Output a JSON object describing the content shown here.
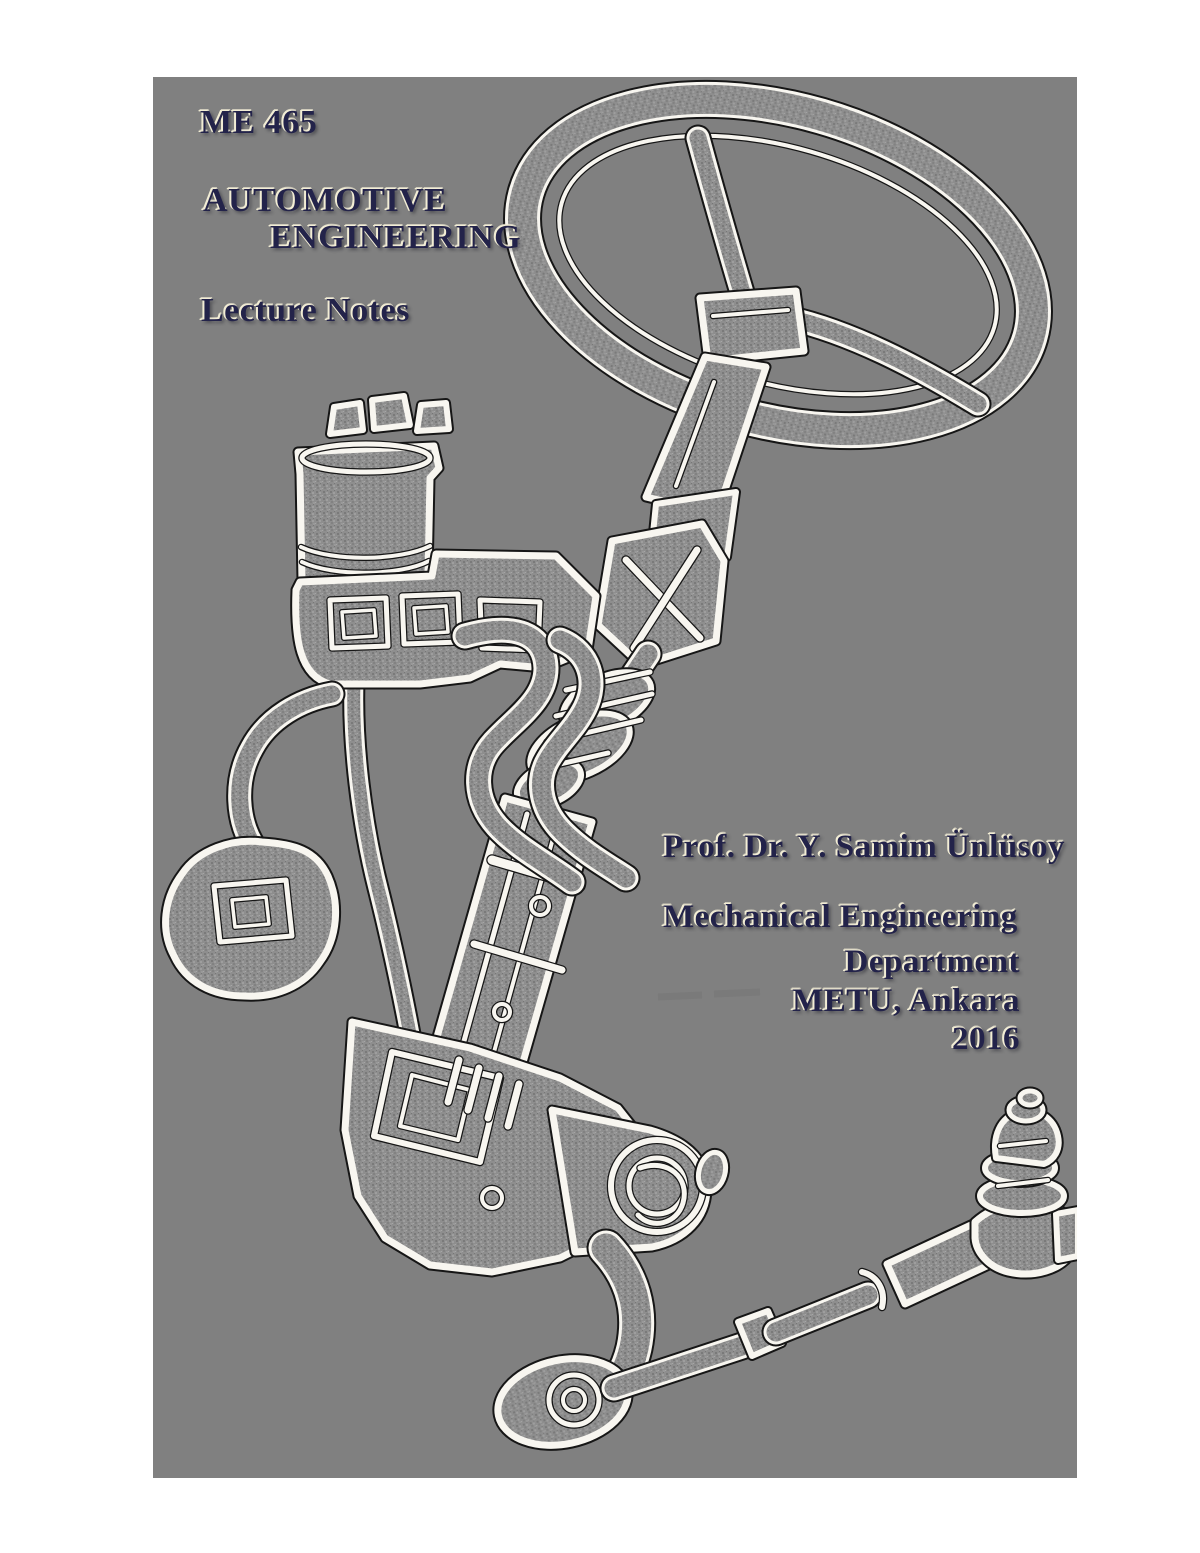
{
  "cover": {
    "course_code": "ME 465",
    "title_line1": "AUTOMOTIVE",
    "title_line2": "ENGINEERING",
    "subtitle": "Lecture Notes",
    "author": "Prof. Dr. Y. Samim Ünlüsoy",
    "department_line1": "Mechanical Engineering",
    "department_line2": "Department",
    "institution": "METU, Ankara",
    "year": "2016",
    "illustration_name": "power-steering-system-embossed-line-art",
    "colors": {
      "page_background": "#ffffff",
      "panel_background": "#808080",
      "text": "#23234a",
      "text_highlight": "#f2edd5",
      "edge_light": "#f8f6f0",
      "edge_dark": "#161616"
    }
  }
}
